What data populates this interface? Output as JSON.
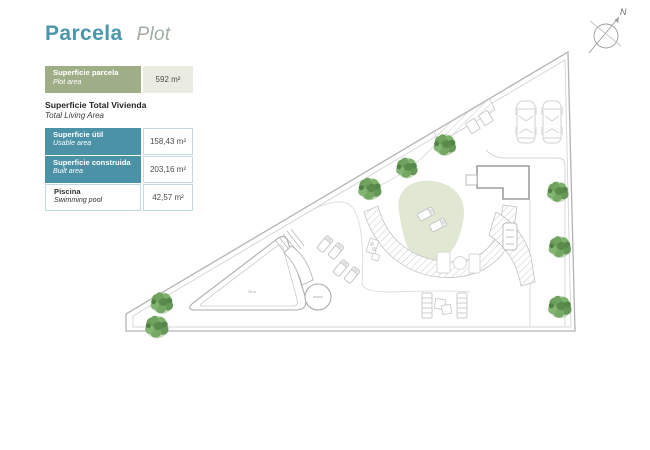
{
  "header": {
    "title_es": "Parcela",
    "title_en": "Plot"
  },
  "compass": {
    "label": "N"
  },
  "legend": {
    "plot_row": {
      "label_es": "Superficie parcela",
      "label_en": "Plot area",
      "value": "592 m²"
    },
    "section_title_es": "Superficie Total Vivienda",
    "section_title_en": "Total Living Area",
    "rows": [
      {
        "label_es": "Superficie útil",
        "label_en": "Usable area",
        "value": "158,43 m²"
      },
      {
        "label_es": "Superficie construida",
        "label_en": "Built area",
        "value": "203,16 m²"
      },
      {
        "label_es": "Piscina",
        "label_en": "Swimming pool",
        "value": "42,57 m²"
      }
    ]
  },
  "plan": {
    "pool_note": "25 m"
  },
  "colors": {
    "title_teal": "#4a96ac",
    "title_sage": "#9fada2",
    "row_sage": "#a0ae88",
    "row_sage_light": "#eaece1",
    "row_teal": "#4b92a7",
    "cell_border": "#c3dae2",
    "tree_green": "#6da05b",
    "lawn_green": "#e0e7d3",
    "line_gray": "#b3b3b3"
  }
}
